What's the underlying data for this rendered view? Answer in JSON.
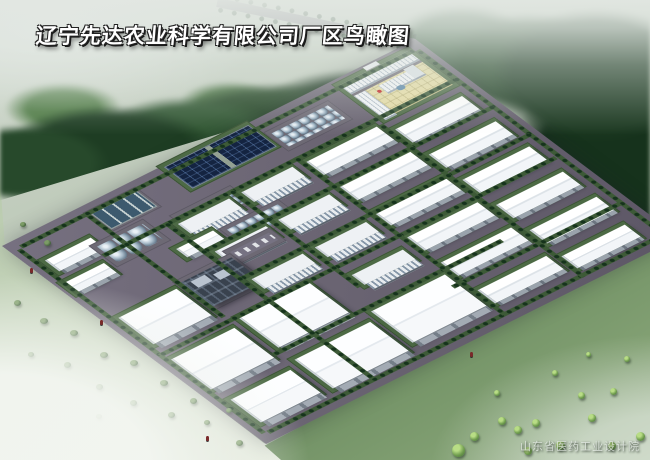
{
  "title": {
    "text": "辽宁先达农业科学有限公司厂区鸟瞰图"
  },
  "watermark": {
    "text": "山东省医药工业设计院"
  },
  "colors": {
    "mist": "#e2e7e2",
    "forest_dark": "#1e3b22",
    "forest_mid": "#2f5531",
    "lawn_pale": "#cdd9c3",
    "lawn_green": "#6f8f63",
    "asphalt": "#6b6573",
    "verge_green": "#3d5a37",
    "roof_white": "#f7fafc",
    "wall_gray": "#9aa3ac",
    "solar_blue": "#142441",
    "tank_steel": "#9fb4c4",
    "courtyard_yellow": "#e6dda6",
    "plant_dark": "#39424e",
    "flag_red": "#c32222"
  },
  "scene": {
    "campus": {
      "buildings": [
        {
          "t": "shed",
          "u": 16,
          "v": 36,
          "l": 50,
          "d": 18
        },
        {
          "t": "shed",
          "u": 8,
          "v": 68,
          "l": 44,
          "d": 16
        },
        {
          "t": "ponds",
          "u": 90,
          "v": 12,
          "l": 50,
          "d": 24
        },
        {
          "t": "tanks-large",
          "u": 64,
          "v": 48,
          "l": 52,
          "d": 26
        },
        {
          "t": "solar",
          "u": 182,
          "v": 2,
          "l": 94,
          "d": 34
        },
        {
          "t": "tanks-row",
          "u": 286,
          "v": 22,
          "l": 64,
          "d": 22
        },
        {
          "t": "tanks-row",
          "u": 146,
          "v": 58,
          "l": 60,
          "d": 20
        },
        {
          "t": "shed",
          "u": 116,
          "v": 90,
          "l": 40,
          "d": 14
        },
        {
          "t": "tanks-row",
          "u": 168,
          "v": 96,
          "l": 58,
          "d": 18
        },
        {
          "t": "lot",
          "u": 150,
          "v": 120,
          "l": 44,
          "d": 12
        },
        {
          "t": "admin",
          "u": 376,
          "v": 8,
          "l": 78,
          "d": 56
        },
        {
          "t": "midrise",
          "u": 140,
          "v": 66,
          "l": 56,
          "d": 16
        },
        {
          "t": "midrise",
          "u": 140,
          "v": 112,
          "l": 56,
          "d": 16
        },
        {
          "t": "midrise",
          "u": 140,
          "v": 158,
          "l": 56,
          "d": 16
        },
        {
          "t": "midrise",
          "u": 212,
          "v": 66,
          "l": 56,
          "d": 16
        },
        {
          "t": "midrise",
          "u": 212,
          "v": 112,
          "l": 56,
          "d": 16
        },
        {
          "t": "midrise",
          "u": 212,
          "v": 158,
          "l": 56,
          "d": 16
        },
        {
          "t": "midrise",
          "u": 212,
          "v": 204,
          "l": 56,
          "d": 16
        },
        {
          "t": "shed",
          "u": 284,
          "v": 68,
          "l": 78,
          "d": 22
        },
        {
          "t": "shed",
          "u": 284,
          "v": 110,
          "l": 78,
          "d": 22
        },
        {
          "t": "shed",
          "u": 284,
          "v": 152,
          "l": 78,
          "d": 22
        },
        {
          "t": "shed",
          "u": 284,
          "v": 194,
          "l": 78,
          "d": 22
        },
        {
          "t": "shed",
          "u": 284,
          "v": 236,
          "l": 78,
          "d": 22
        },
        {
          "t": "shed",
          "u": 374,
          "v": 80,
          "l": 74,
          "d": 22
        },
        {
          "t": "shed",
          "u": 374,
          "v": 122,
          "l": 74,
          "d": 22
        },
        {
          "t": "shed",
          "u": 374,
          "v": 164,
          "l": 74,
          "d": 22
        },
        {
          "t": "shed",
          "u": 374,
          "v": 206,
          "l": 74,
          "d": 22
        },
        {
          "t": "shed",
          "u": 374,
          "v": 248,
          "l": 74,
          "d": 22
        },
        {
          "t": "big",
          "u": 14,
          "v": 130,
          "l": 64,
          "d": 44
        },
        {
          "t": "plant",
          "u": 88,
          "v": 126,
          "l": 56,
          "d": 40
        },
        {
          "t": "big",
          "u": 12,
          "v": 198,
          "l": 70,
          "d": 50
        },
        {
          "t": "big",
          "u": 96,
          "v": 190,
          "l": 78,
          "d": 50
        },
        {
          "t": "big",
          "u": 16,
          "v": 268,
          "l": 66,
          "d": 38
        },
        {
          "t": "big",
          "u": 96,
          "v": 260,
          "l": 84,
          "d": 48
        },
        {
          "t": "big",
          "u": 192,
          "v": 250,
          "l": 82,
          "d": 52
        },
        {
          "t": "shed",
          "u": 284,
          "v": 282,
          "l": 76,
          "d": 22
        },
        {
          "t": "shed",
          "u": 372,
          "v": 290,
          "l": 70,
          "d": 20
        }
      ],
      "tree_lines": [
        {
          "dir": "h",
          "u": 12,
          "v": 8,
          "len": 446
        },
        {
          "dir": "h",
          "u": 12,
          "v": 317,
          "len": 446
        },
        {
          "dir": "v",
          "u": 6,
          "v": 12,
          "len": 306
        },
        {
          "dir": "v",
          "u": 459,
          "v": 12,
          "len": 306
        },
        {
          "dir": "h",
          "u": 60,
          "v": 58,
          "len": 400
        },
        {
          "dir": "h",
          "u": 132,
          "v": 104,
          "len": 330
        },
        {
          "dir": "h",
          "u": 132,
          "v": 150,
          "len": 330
        },
        {
          "dir": "h",
          "u": 8,
          "v": 186,
          "len": 450
        },
        {
          "dir": "h",
          "u": 86,
          "v": 242,
          "len": 260
        },
        {
          "dir": "h",
          "u": 270,
          "v": 264,
          "len": 190
        },
        {
          "dir": "v",
          "u": 130,
          "v": 58,
          "len": 260
        },
        {
          "dir": "v",
          "u": 204,
          "v": 58,
          "len": 162
        },
        {
          "dir": "v",
          "u": 278,
          "v": 58,
          "len": 262
        },
        {
          "dir": "v",
          "u": 366,
          "v": 68,
          "len": 254
        },
        {
          "dir": "v",
          "u": 84,
          "v": 12,
          "len": 170
        }
      ]
    },
    "scenery": {
      "bushes": [
        [
          20,
          222,
          6
        ],
        [
          44,
          240,
          7
        ],
        [
          14,
          300,
          7
        ],
        [
          40,
          318,
          8
        ],
        [
          70,
          330,
          8
        ],
        [
          100,
          352,
          8
        ],
        [
          130,
          360,
          8
        ],
        [
          160,
          380,
          8
        ],
        [
          190,
          398,
          7
        ],
        [
          64,
          362,
          7
        ],
        [
          96,
          384,
          7
        ],
        [
          130,
          400,
          7
        ],
        [
          168,
          412,
          7
        ],
        [
          204,
          420,
          6
        ],
        [
          236,
          440,
          7
        ],
        [
          28,
          352,
          6
        ],
        [
          226,
          408,
          6
        ],
        [
          96,
          414,
          6
        ]
      ],
      "se_trees": [
        [
          452,
          444,
          13
        ],
        [
          470,
          432,
          9
        ],
        [
          498,
          417,
          8
        ],
        [
          514,
          426,
          8
        ],
        [
          532,
          419,
          8
        ],
        [
          556,
          441,
          9
        ],
        [
          588,
          414,
          8
        ],
        [
          610,
          388,
          7
        ],
        [
          636,
          432,
          9
        ],
        [
          578,
          392,
          7
        ],
        [
          524,
          447,
          8
        ],
        [
          608,
          442,
          8
        ],
        [
          494,
          390,
          6
        ],
        [
          552,
          370,
          6
        ],
        [
          624,
          356,
          6
        ],
        [
          586,
          352,
          5
        ]
      ],
      "figures": [
        [
          30,
          268
        ],
        [
          100,
          320
        ],
        [
          206,
          436
        ],
        [
          470,
          352
        ]
      ]
    }
  }
}
